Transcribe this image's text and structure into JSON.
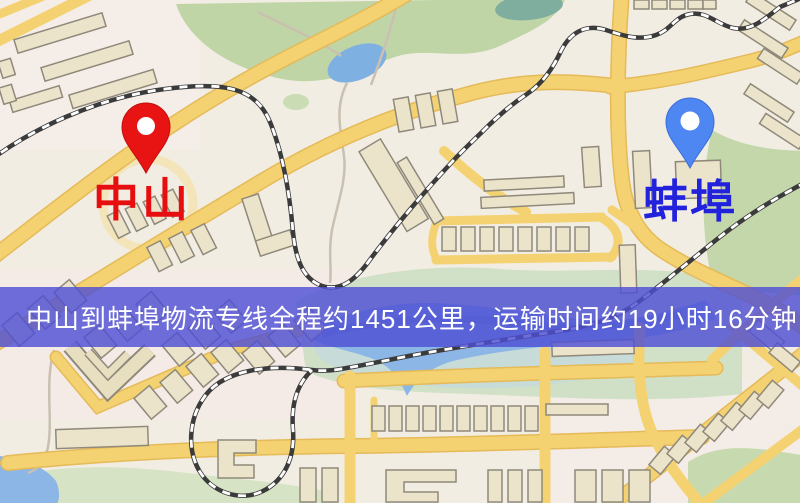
{
  "map": {
    "origin": {
      "label": "中山",
      "pin_color": "#e81414",
      "label_color": "#e60e0e"
    },
    "destination": {
      "label": "蚌埠",
      "pin_color": "#4e86f2",
      "label_color": "#2222dd"
    },
    "colors": {
      "background": "#f2ede3",
      "road": "#f4d271",
      "park": "#bfd5a6",
      "water": "#8cb6e6",
      "railway": "#3b3b3b",
      "building": "#ece4ca"
    }
  },
  "banner": {
    "text": "中山到蚌埠物流专线全程约1451公里，运输时间约19小时16分钟.",
    "background_color": "#4f4fd4",
    "text_color": "#ffffff"
  },
  "route": {
    "distance_km": "1451",
    "duration_hours": "19",
    "duration_minutes": "16"
  }
}
